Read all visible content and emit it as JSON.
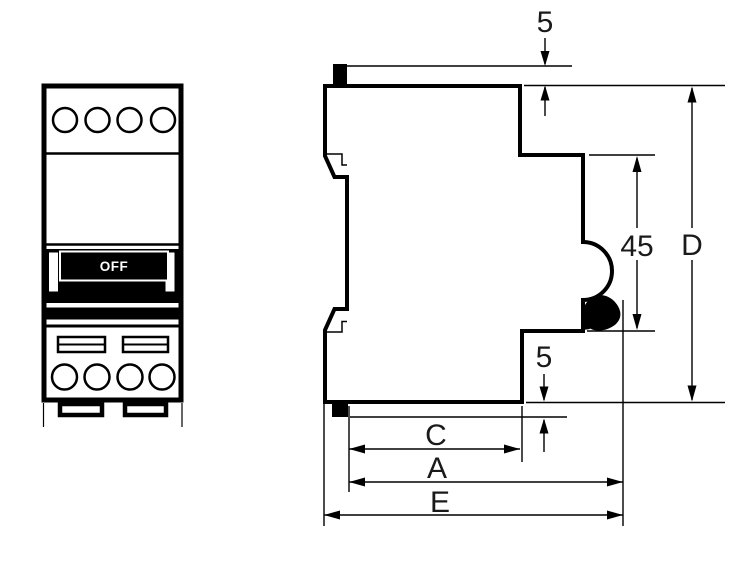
{
  "drawing": {
    "description": "Two-view technical dimension drawing of a DIN-rail miniature circuit breaker: front view (left) and side profile with dimension callouts (right)",
    "toggle_label": "OFF",
    "dimensions": {
      "top_protrusion": "5",
      "bottom_protrusion": "5",
      "din_height": "45",
      "overall_height": "D",
      "depth_c": "C",
      "depth_a": "A",
      "depth_e": "E"
    },
    "colors": {
      "line": "#000000",
      "background": "#ffffff",
      "label_text": "#1a1a1a"
    }
  }
}
